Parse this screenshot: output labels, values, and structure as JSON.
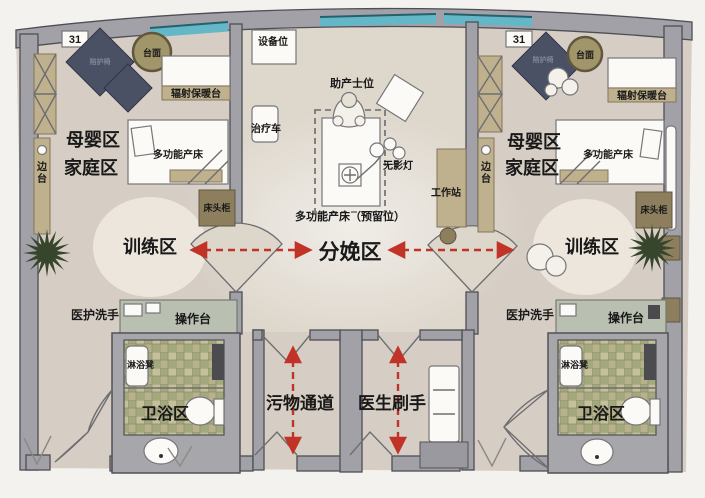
{
  "plan": {
    "badge": "31",
    "zones": {
      "mother": "母婴区",
      "family": "家庭区",
      "training": "训练区",
      "delivery": "分娩区",
      "bath": "卫浴区",
      "waste_corridor": "污物通道",
      "doctor_scrub": "医生刷手"
    },
    "furniture": {
      "round_table": "台面",
      "companion_chair": "陪护椅",
      "warming_table": "辐射保暖台",
      "delivery_bed": "多功能产床",
      "reserved_bed": "多功能产床（预留位）",
      "nightstand": "床头柜",
      "side_table": "边台",
      "staff_wash": "医护洗手",
      "counter": "操作台",
      "shower_stool": "淋浴凳",
      "equipment_spot": "设备位",
      "treatment_cart": "治疗车",
      "midwife_position": "助产士位",
      "surgical_lamp": "无影灯",
      "workstation": "工作站"
    }
  },
  "colors": {
    "arrow_red": "#c13327",
    "teal": "#63b7c7",
    "wall": "#a2a1a8",
    "floor": "#d6cec4",
    "center_floor": "#ded7cc",
    "tile_base": "#b2ae86",
    "tan": "#c0b18e",
    "dark_tan": "#8d7f5e",
    "navy": "#4a5165",
    "counter": "#b9bfb1",
    "plant": "#36452c"
  }
}
